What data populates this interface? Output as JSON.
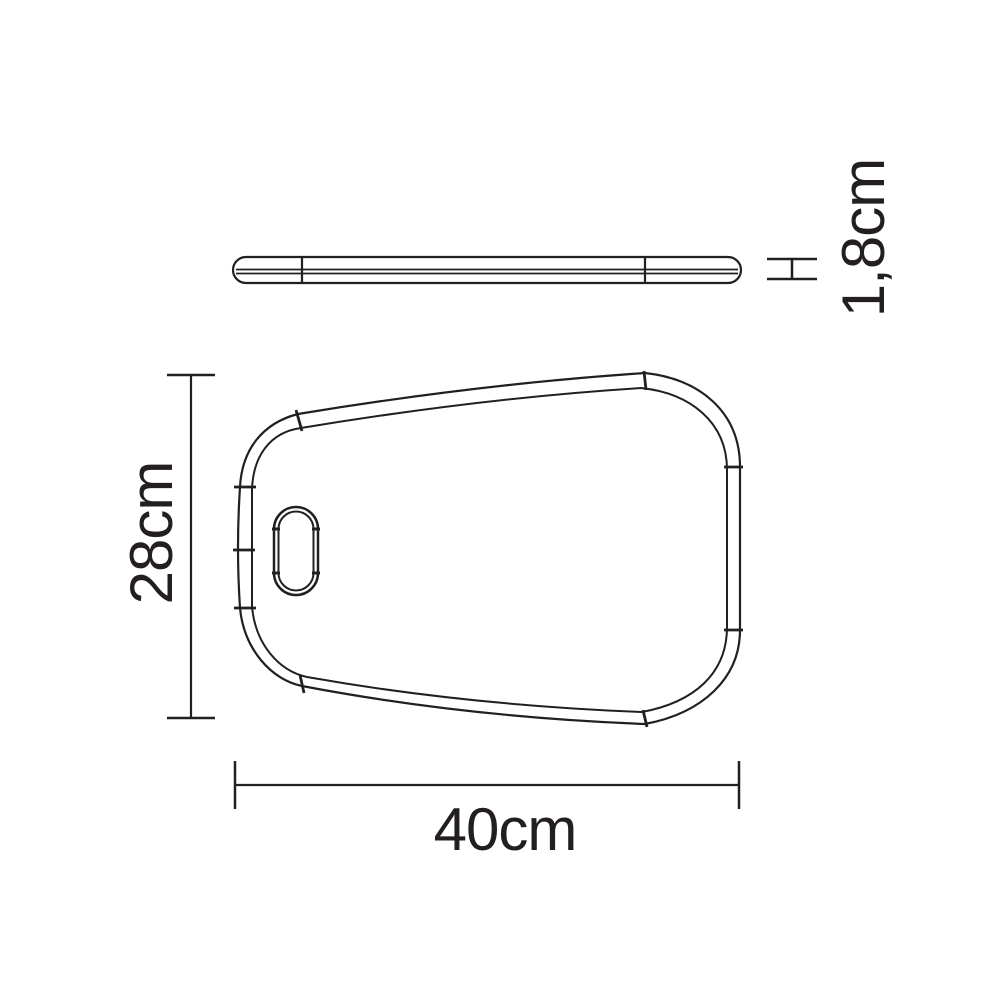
{
  "diagram": {
    "line_color": "#231f20",
    "background_color": "#ffffff",
    "dimensions": {
      "width": {
        "label": "40cm"
      },
      "height": {
        "label": "28cm"
      },
      "thickness": {
        "label": "1,8cm"
      }
    }
  }
}
